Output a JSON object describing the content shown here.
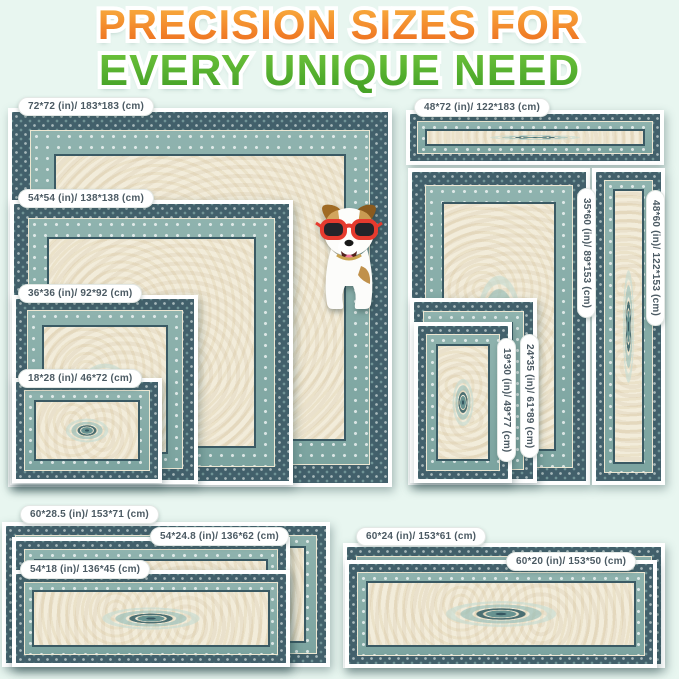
{
  "title": {
    "line1": "PRECISION SIZES FOR",
    "line2": "EVERY UNIQUE NEED"
  },
  "sizes": {
    "sq72": "72*72 (in)/ 183*183 (cm)",
    "sq54": "54*54 (in)/ 138*138 (cm)",
    "sq36": "36*36 (in)/ 92*92 (cm)",
    "sq18": "18*28 (in)/ 46*72 (cm)",
    "v48x72": "48*72 (in)/ 122*183 (cm)",
    "v48x60": "48*60 (in)/ 122*153 (cm)",
    "v35x60": "35*60 (in)/ 89*153 (cm)",
    "v24x35": "24*35 (in)/ 61*89 (cm)",
    "v19x30": "19*30 (in)/ 49*77 (cm)",
    "r60x285": "60*28.5 (in)/ 153*71 (cm)",
    "r54x248": "54*24.8 (in)/ 136*62 (cm)",
    "r54x18": "54*18 (in)/ 136*45 (cm)",
    "r60x24": "60*24 (in)/ 153*61 (cm)",
    "r60x20": "60*20 (in)/ 153*50 (cm)"
  },
  "colors": {
    "title_orange": "#ee7120",
    "title_green": "#53b22f",
    "background": "#e8f6f0",
    "label_text": "#4b5a63",
    "rug_teal_dark": "#42606b",
    "rug_teal_light": "#8fb3ae",
    "rug_cream": "#f2ecda",
    "dog_glasses_red": "#e63a2e"
  },
  "decor": {
    "dog_alt": "dog wearing red sunglasses sitting on rug"
  }
}
